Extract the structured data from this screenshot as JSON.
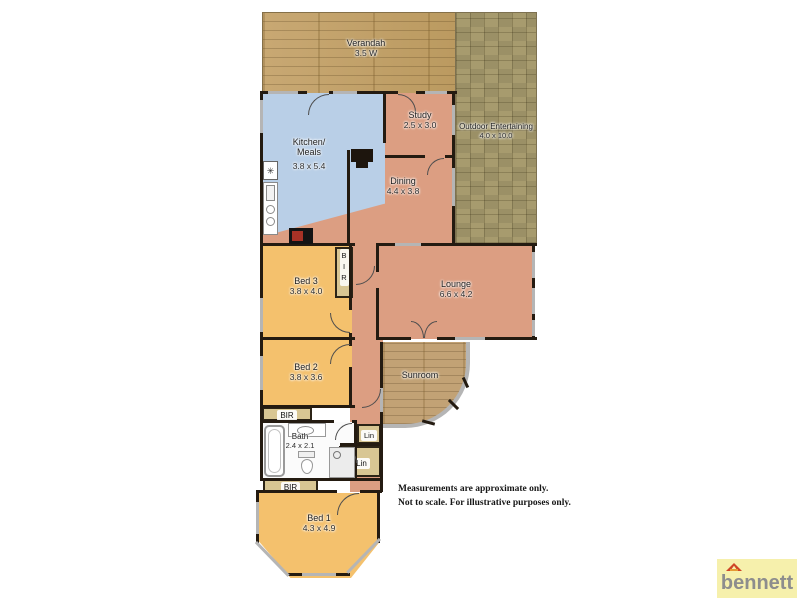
{
  "plan": {
    "rooms": {
      "verandah": {
        "name": "Verandah",
        "dims": "3.5 W"
      },
      "outdoor_entertaining": {
        "name": "Outdoor Entertaining",
        "dims": "4.0 x 10.0"
      },
      "kitchen_meals": {
        "name_line1": "Kitchen/",
        "name_line2": "Meals",
        "dims": "3.8 x 5.4"
      },
      "study": {
        "name": "Study",
        "dims": "2.5 x 3.0"
      },
      "dining": {
        "name": "Dining",
        "dims": "4.4 x 3.8"
      },
      "lounge": {
        "name": "Lounge",
        "dims": "6.6 x 4.2"
      },
      "sunroom": {
        "name": "Sunroom"
      },
      "bed1": {
        "name": "Bed 1",
        "dims": "4.3 x 4.9"
      },
      "bed2": {
        "name": "Bed 2",
        "dims": "3.8 x 3.6"
      },
      "bed3": {
        "name": "Bed 3",
        "dims": "3.8 x 4.0"
      },
      "bath": {
        "name": "Bath",
        "dims": "2.4 x 2.1"
      }
    },
    "closets": {
      "bir_bed3": "BIR",
      "bir_bed2": "BIR",
      "bir_bed1": "BIR",
      "lin_upper": "Lin",
      "lin_lower": "Lin"
    },
    "icons": {
      "extractor": "✳"
    },
    "disclaimer": {
      "line1": "Measurements are approximate only.",
      "line2": "Not to scale.  For illustrative purposes only."
    },
    "branding": {
      "agency": "bennett"
    }
  },
  "colors": {
    "wall": "#241b11",
    "window": "#b5b5b5",
    "living_area": "#dc9e82",
    "bedroom": "#f4c16d",
    "kitchen": "#b9cfe7",
    "closet": "#d8c693",
    "verandah_deck": "#c2a26c",
    "outdoor_pavers": "#a79b6e",
    "sunroom_floor": "#c2a275",
    "logo_bg": "#f6f0ac",
    "logo_text": "#8d8d8d",
    "logo_roof": "#cf4526"
  }
}
